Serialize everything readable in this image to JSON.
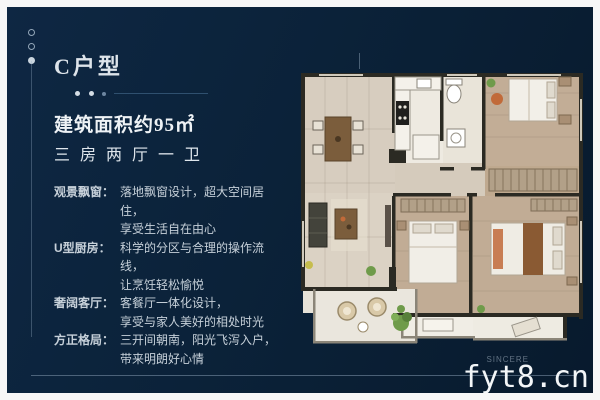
{
  "header": {
    "title": "C户型"
  },
  "specs": {
    "area": "建筑面积约95㎡",
    "rooms": "三房两厅一卫"
  },
  "features": [
    {
      "label": "观景飘窗：",
      "line1": "落地飘窗设计，超大空间居住，",
      "line2": "享受生活自在由心"
    },
    {
      "label": "U型厨房：",
      "line1": "科学的分区与合理的操作流线，",
      "line2": "让烹饪轻松愉悦"
    },
    {
      "label": "奢阔客厅：",
      "line1": "客餐厅一体化设计，",
      "line2": "享受与家人美好的相处时光"
    },
    {
      "label": "方正格局：",
      "line1": "三开间朝南，阳光飞泻入户，",
      "line2": "带来明朗好心情"
    }
  ],
  "footer": {
    "watermark": "fyt8.cn",
    "brand_ghost": "SINCERE"
  },
  "colors": {
    "panel_background": "#0b2239",
    "frame": "#f7f7f7",
    "text": "#dfe6ec",
    "wall": "#2b2a23",
    "floor_light": "#d7cdbf",
    "floor_wood": "#c2ad96",
    "plant_green": "#6f9b4a",
    "table_brown": "#7b5d3c"
  }
}
